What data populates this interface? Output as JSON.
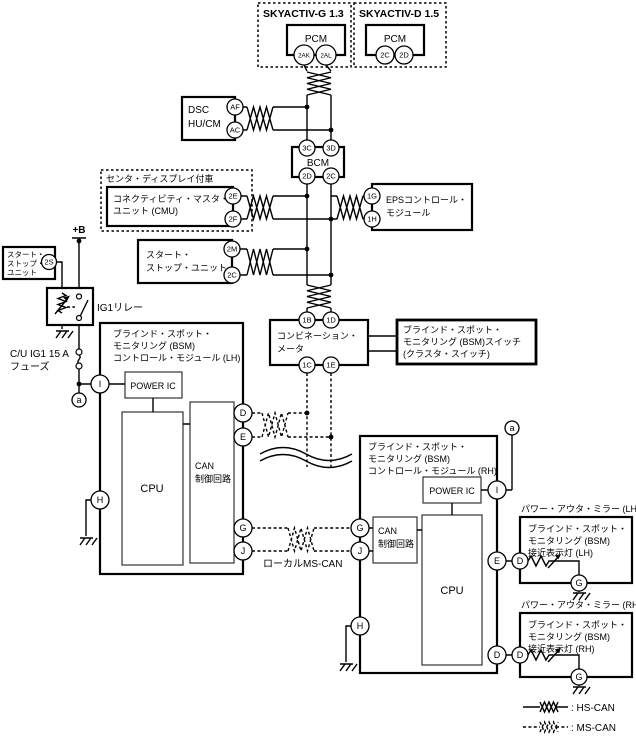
{
  "diagram": {
    "pcm_g": {
      "variant": "SKYACTIV-G 1.3",
      "name": "PCM",
      "pin1": "2AK",
      "pin2": "2AL"
    },
    "pcm_d": {
      "variant": "SKYACTIV-D 1.5",
      "name": "PCM",
      "pin1": "2C",
      "pin2": "2D"
    },
    "dsc": {
      "name1": "DSC",
      "name2": "HU/CM",
      "pin1": "AF",
      "pin2": "AC"
    },
    "bcm": {
      "name": "BCM",
      "pin_tl": "3C",
      "pin_tr": "3D",
      "pin_bl": "2D",
      "pin_br": "2C"
    },
    "cmu": {
      "note": "センタ・ディスプレイ付車",
      "name1": "コネクティビティ・マスタ・",
      "name2": "ユニット (CMU)",
      "pin1": "2E",
      "pin2": "2F"
    },
    "eps": {
      "name1": "EPSコントロール・",
      "name2": "モジュール",
      "pin1": "1G",
      "pin2": "1H"
    },
    "start_stop": {
      "name1": "スタート・",
      "name2": "ストップ・ユニット",
      "pin1": "2M",
      "pin2": "2C"
    },
    "start_stop_small": {
      "name1": "スタート・",
      "name2": "ストップ・",
      "name3": "ユニット",
      "pin": "2S"
    },
    "power_feed": {
      "plus_b": "+B",
      "relay": "IG1リレー",
      "fuse1": "C/U IG1 15 A",
      "fuse2": "フューズ"
    },
    "meter": {
      "name1": "コンビネーション・",
      "name2": "メータ",
      "pin_tl": "1B",
      "pin_tr": "1D",
      "pin_bl": "1C",
      "pin_br": "1E"
    },
    "bsm_switch": {
      "name1": "ブラインド・スポット・",
      "name2": "モニタリング (BSM)スイッチ",
      "name3": "(クラスタ・スイッチ)"
    },
    "bsm_lh": {
      "name1": "ブラインド・スポット・",
      "name2": "モニタリング (BSM)",
      "name3": "コントロール・モジュール (LH)",
      "power_ic": "POWER IC",
      "cpu": "CPU",
      "can1": "CAN",
      "can2": "制御回路",
      "pin_i": "I",
      "pin_h": "H",
      "pin_d": "D",
      "pin_e": "E",
      "pin_g": "G",
      "pin_j": "J",
      "pin_a": "a"
    },
    "bsm_rh": {
      "name1": "ブラインド・スポット・",
      "name2": "モニタリング (BSM)",
      "name3": "コントロール・モジュール (RH)",
      "power_ic": "POWER IC",
      "cpu": "CPU",
      "can1": "CAN",
      "can2": "制御回路",
      "pin_i": "I",
      "pin_h": "H",
      "pin_d": "D",
      "pin_e": "E",
      "pin_g": "G",
      "pin_j": "J",
      "pin_a": "a"
    },
    "local_bus": {
      "label": "ローカルMS-CAN"
    },
    "mirror_lh": {
      "title": "パワー・アウタ・ミラー (LH)",
      "name1": "ブラインド・スポット・",
      "name2": "モニタリング (BSM)",
      "name3": "接近表示灯 (LH)",
      "pin_d": "D",
      "pin_g": "G"
    },
    "mirror_rh": {
      "title": "パワー・アウタ・ミラー (RH)",
      "name1": "ブラインド・スポット・",
      "name2": "モニタリング (BSM)",
      "name3": "接近表示灯 (RH)",
      "pin_d": "D",
      "pin_g": "G"
    },
    "legend": {
      "hs": ": HS-CAN",
      "ms": ": MS-CAN"
    },
    "colors": {
      "line": "#000000",
      "bg": "#ffffff"
    }
  }
}
